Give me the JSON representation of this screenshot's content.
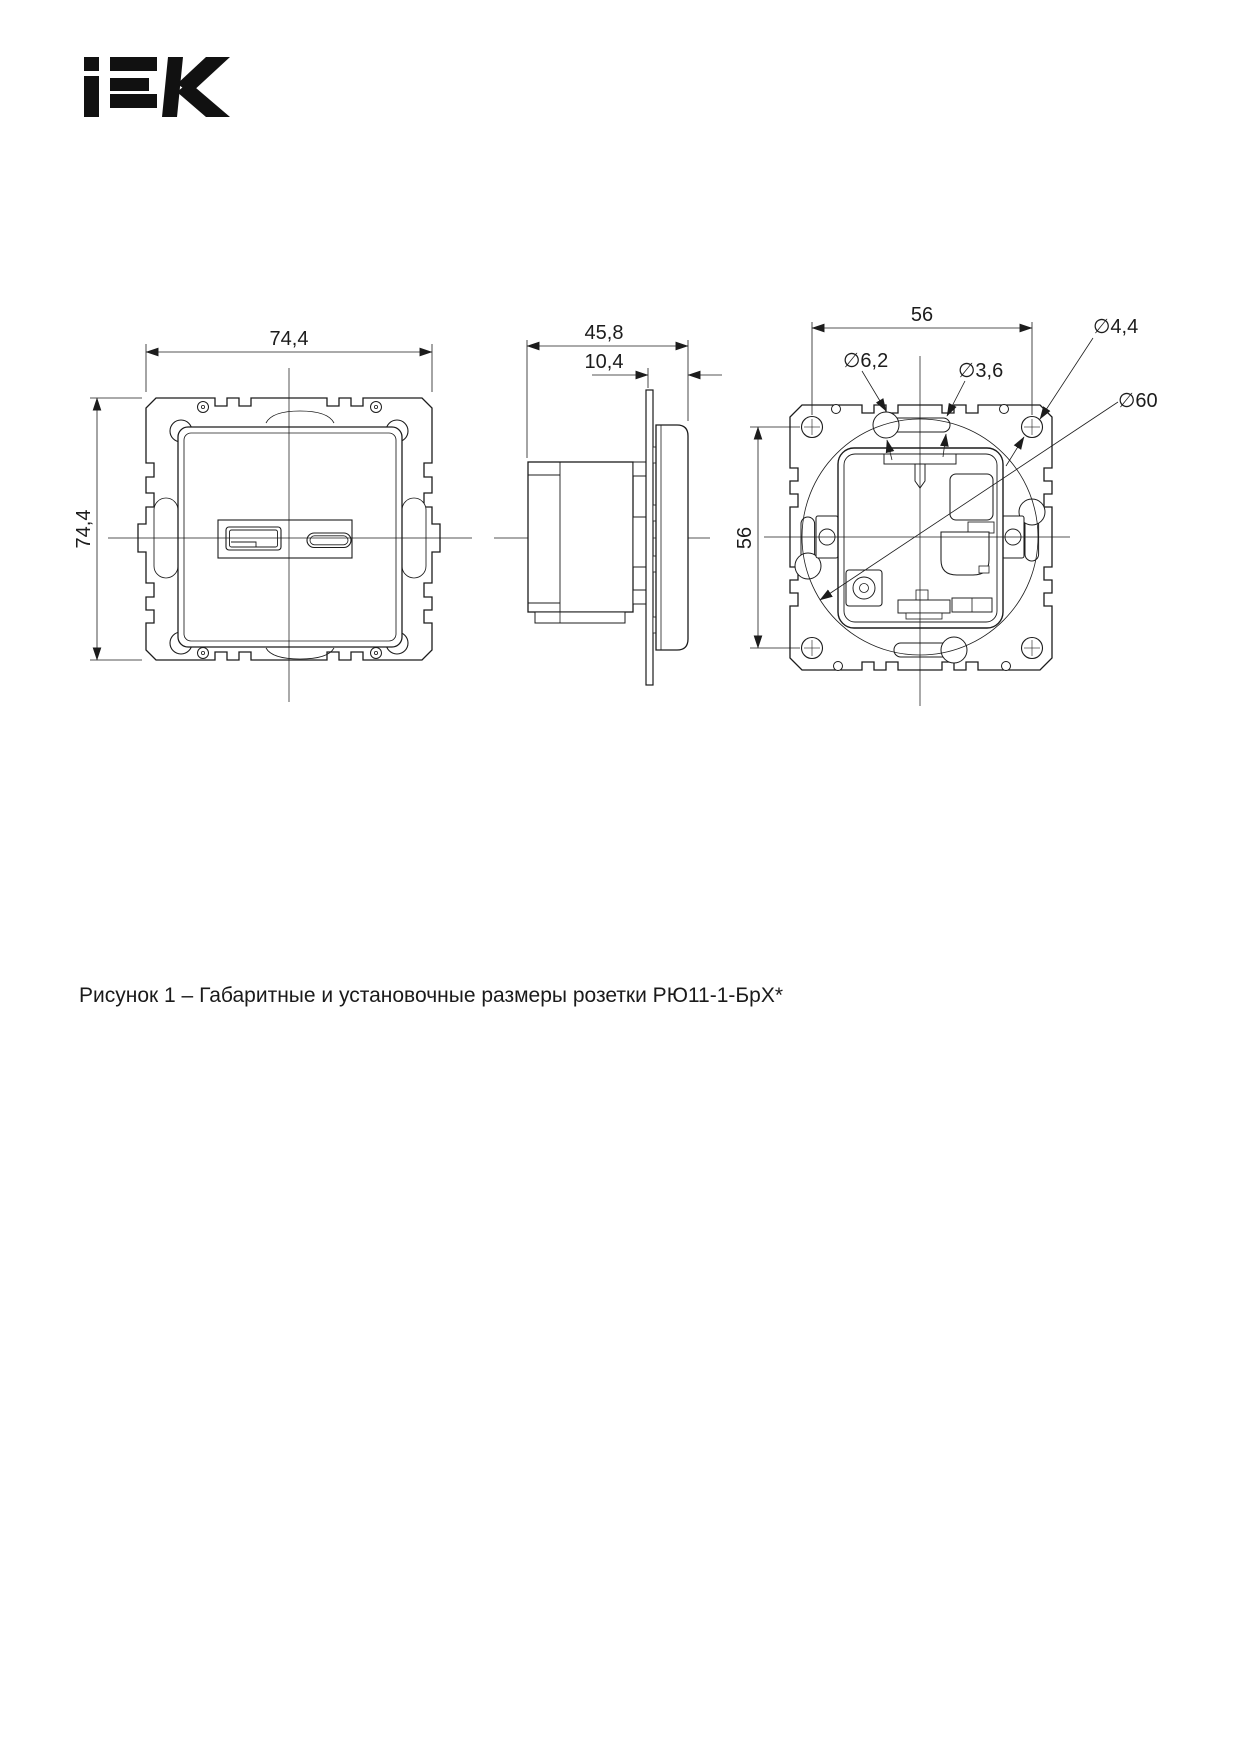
{
  "page": {
    "background": "#ffffff",
    "ink_color": "#1c1c1c"
  },
  "logo": {
    "brand": "IEK"
  },
  "figure": {
    "views": {
      "front": {
        "width_label": "74,4",
        "height_label": "74,4"
      },
      "side": {
        "depth_label": "45,8",
        "face_depth_label": "10,4"
      },
      "rear": {
        "hole_spacing_h_label": "56",
        "hole_spacing_v_label": "56",
        "slot_dia_label": "∅6,2",
        "slot_narrow_dia_label": "∅3,6",
        "screw_hole_dia_label": "∅4,4",
        "install_dia_label": "∅60"
      }
    },
    "caption": "Рисунок 1 – Габаритные и установочные размеры розетки РЮ11-1-БрХ*"
  }
}
